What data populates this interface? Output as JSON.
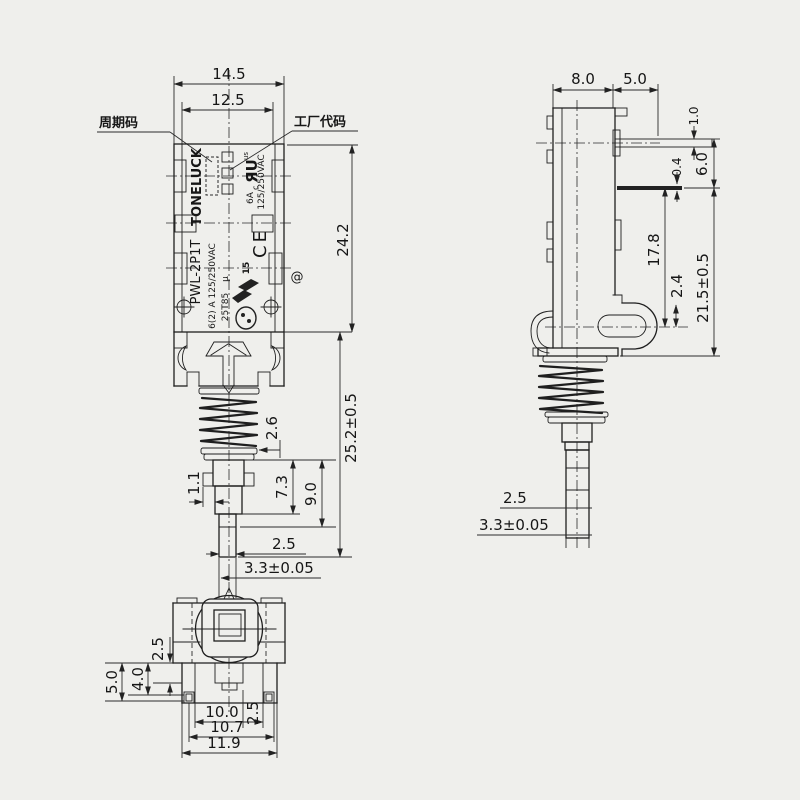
{
  "front_view": {
    "callouts": {
      "cycle_code": "周期码",
      "factory_code": "工厂代码"
    },
    "markings": {
      "brand": "TONELUCK",
      "model": "PWL-2P1T",
      "rating_line1": "6(2) A 125/250VAC",
      "rating_line2": "25T85",
      "mu": "μ",
      "ul_c": "c",
      "ul_mark": "ЯU",
      "ul_us": "us",
      "ul_current": "6A",
      "ul_voltage": "125/250VAC",
      "ce_mark": "CE",
      "enec_number": "15",
      "at_symbol": "@"
    },
    "dims": {
      "width_outer": "14.5",
      "width_inner": "12.5",
      "body_height": "24.2",
      "total_height": "25.2±0.5",
      "spring_step": "2.6",
      "ear_width": "1.1",
      "shaft_upper": "7.3",
      "shaft_total": "9.0",
      "tip_width": "2.5",
      "tip_diameter": "3.3±0.05"
    }
  },
  "side_view": {
    "dims": {
      "body_depth": "8.0",
      "terminal_length": "5.0",
      "terminal_thickness": "1.0",
      "terminal_thickness_2": "0.4",
      "terminal_height": "6.0",
      "body_height": "17.8",
      "bracket_offset": "2.4",
      "total_height": "21.5±0.5",
      "tip_width": "2.5",
      "tip_diameter": "3.3±0.05"
    }
  },
  "bottom_view": {
    "dims": {
      "edge_offset": "2.5",
      "foot_height": "5.0",
      "foot_inner_height": "4.0",
      "inner_width": "10.0",
      "tab_offset": "2.5",
      "mid_width": "10.7",
      "outer_width": "11.9"
    }
  }
}
